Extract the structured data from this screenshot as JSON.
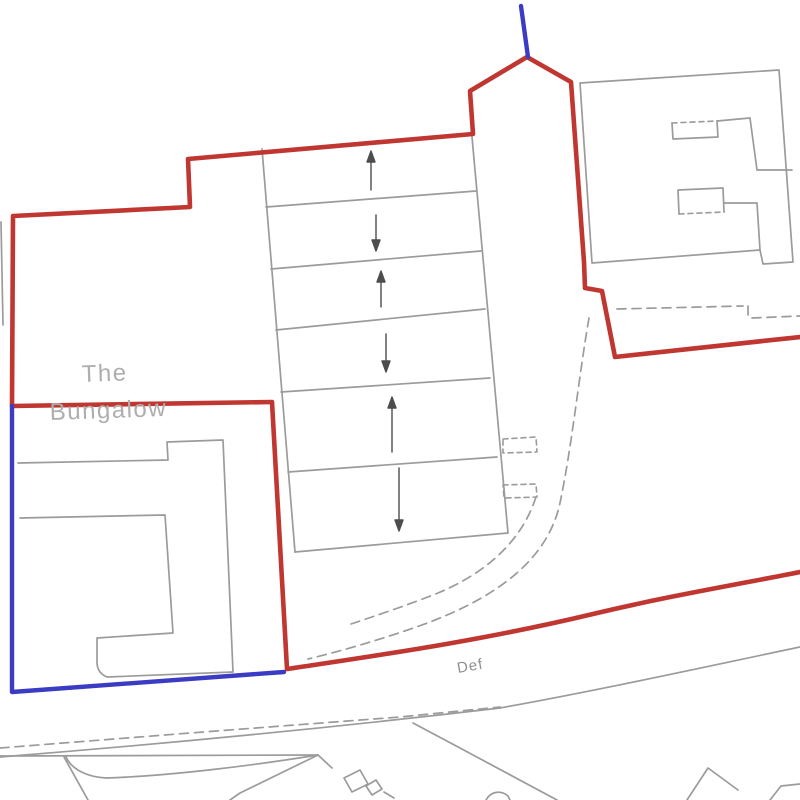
{
  "labels": {
    "property_line1": "The",
    "property_line2": "Bungalow",
    "road_annotation": "Def"
  },
  "colors": {
    "boundary_red": "#c03631",
    "boundary_blue": "#3b3bc4",
    "map_gray": "#9b9b9b",
    "arrow": "#4d4d4d",
    "label_gray": "#aeaeae",
    "road_label_gray": "#8f8f8f",
    "background": "#ffffff"
  },
  "arrows": {
    "count": 6,
    "directions": [
      "up",
      "down",
      "up",
      "down",
      "up",
      "down"
    ]
  }
}
